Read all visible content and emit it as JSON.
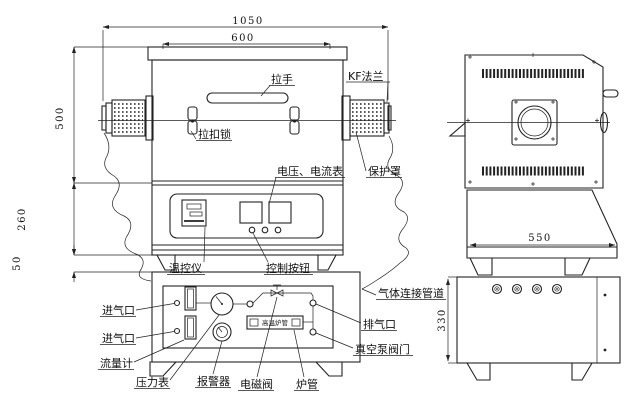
{
  "colors": {
    "ink": "#222222",
    "background": "#ffffff"
  },
  "front_view": {
    "dimensions": {
      "total_width": "1050",
      "lid_width": "600",
      "furnace_height": "500",
      "control_height": "260",
      "base_height": "50"
    },
    "labels": {
      "handle": "拉手",
      "kf_flange": "KF法兰",
      "latch_lock": "拉扣锁",
      "protective_cover": "保护罩",
      "volt_ammeter": "电压、电流表",
      "temp_controller": "温控仪",
      "control_buttons": "控制按钮",
      "gas_inlet_top": "进气口",
      "gas_inlet_bottom": "进气口",
      "flow_meter": "流量计",
      "pressure_gauge": "压力表",
      "alarm": "报警器",
      "solenoid_valve": "电磁阀",
      "furnace_tube": "炉管",
      "exhaust_port": "排气口",
      "vacuum_pump_valve": "真空泵阀门",
      "gas_connection_pipe": "气体连接管道",
      "tube_box": "高温炉管"
    }
  },
  "side_view": {
    "dimensions": {
      "body_depth": "550",
      "cabinet_height": "330"
    }
  }
}
